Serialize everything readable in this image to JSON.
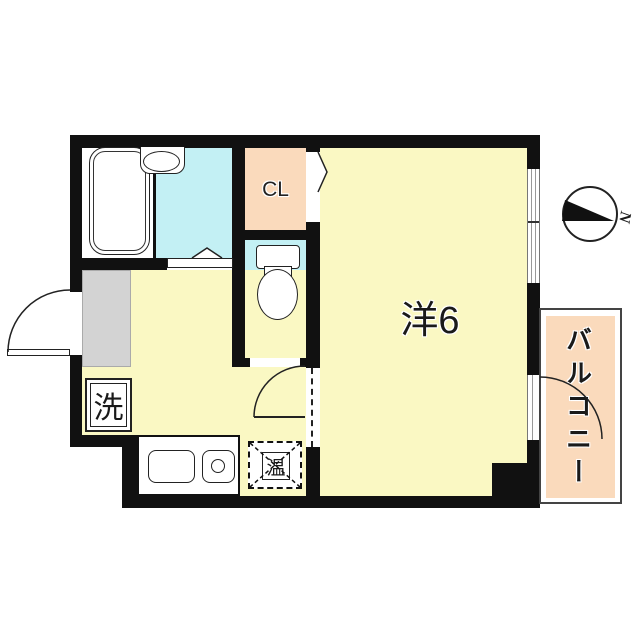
{
  "colors": {
    "wall": "#111111",
    "line": "#222222",
    "room_yellow": "#FAF8C3",
    "room_cyan": "#C3F0F4",
    "room_salmon": "#FADABC",
    "genkan_gray": "#D3D3D3",
    "balcony_border": "#444444"
  },
  "rooms": {
    "closet": {
      "label": "CL"
    },
    "western_room": {
      "label": "洋6"
    },
    "balcony": {
      "label": "バルコニー"
    }
  },
  "fixtures": {
    "washing_machine": {
      "label": "洗"
    },
    "water_heater": {
      "label": "温"
    }
  },
  "compass": {
    "north_label": "N"
  }
}
